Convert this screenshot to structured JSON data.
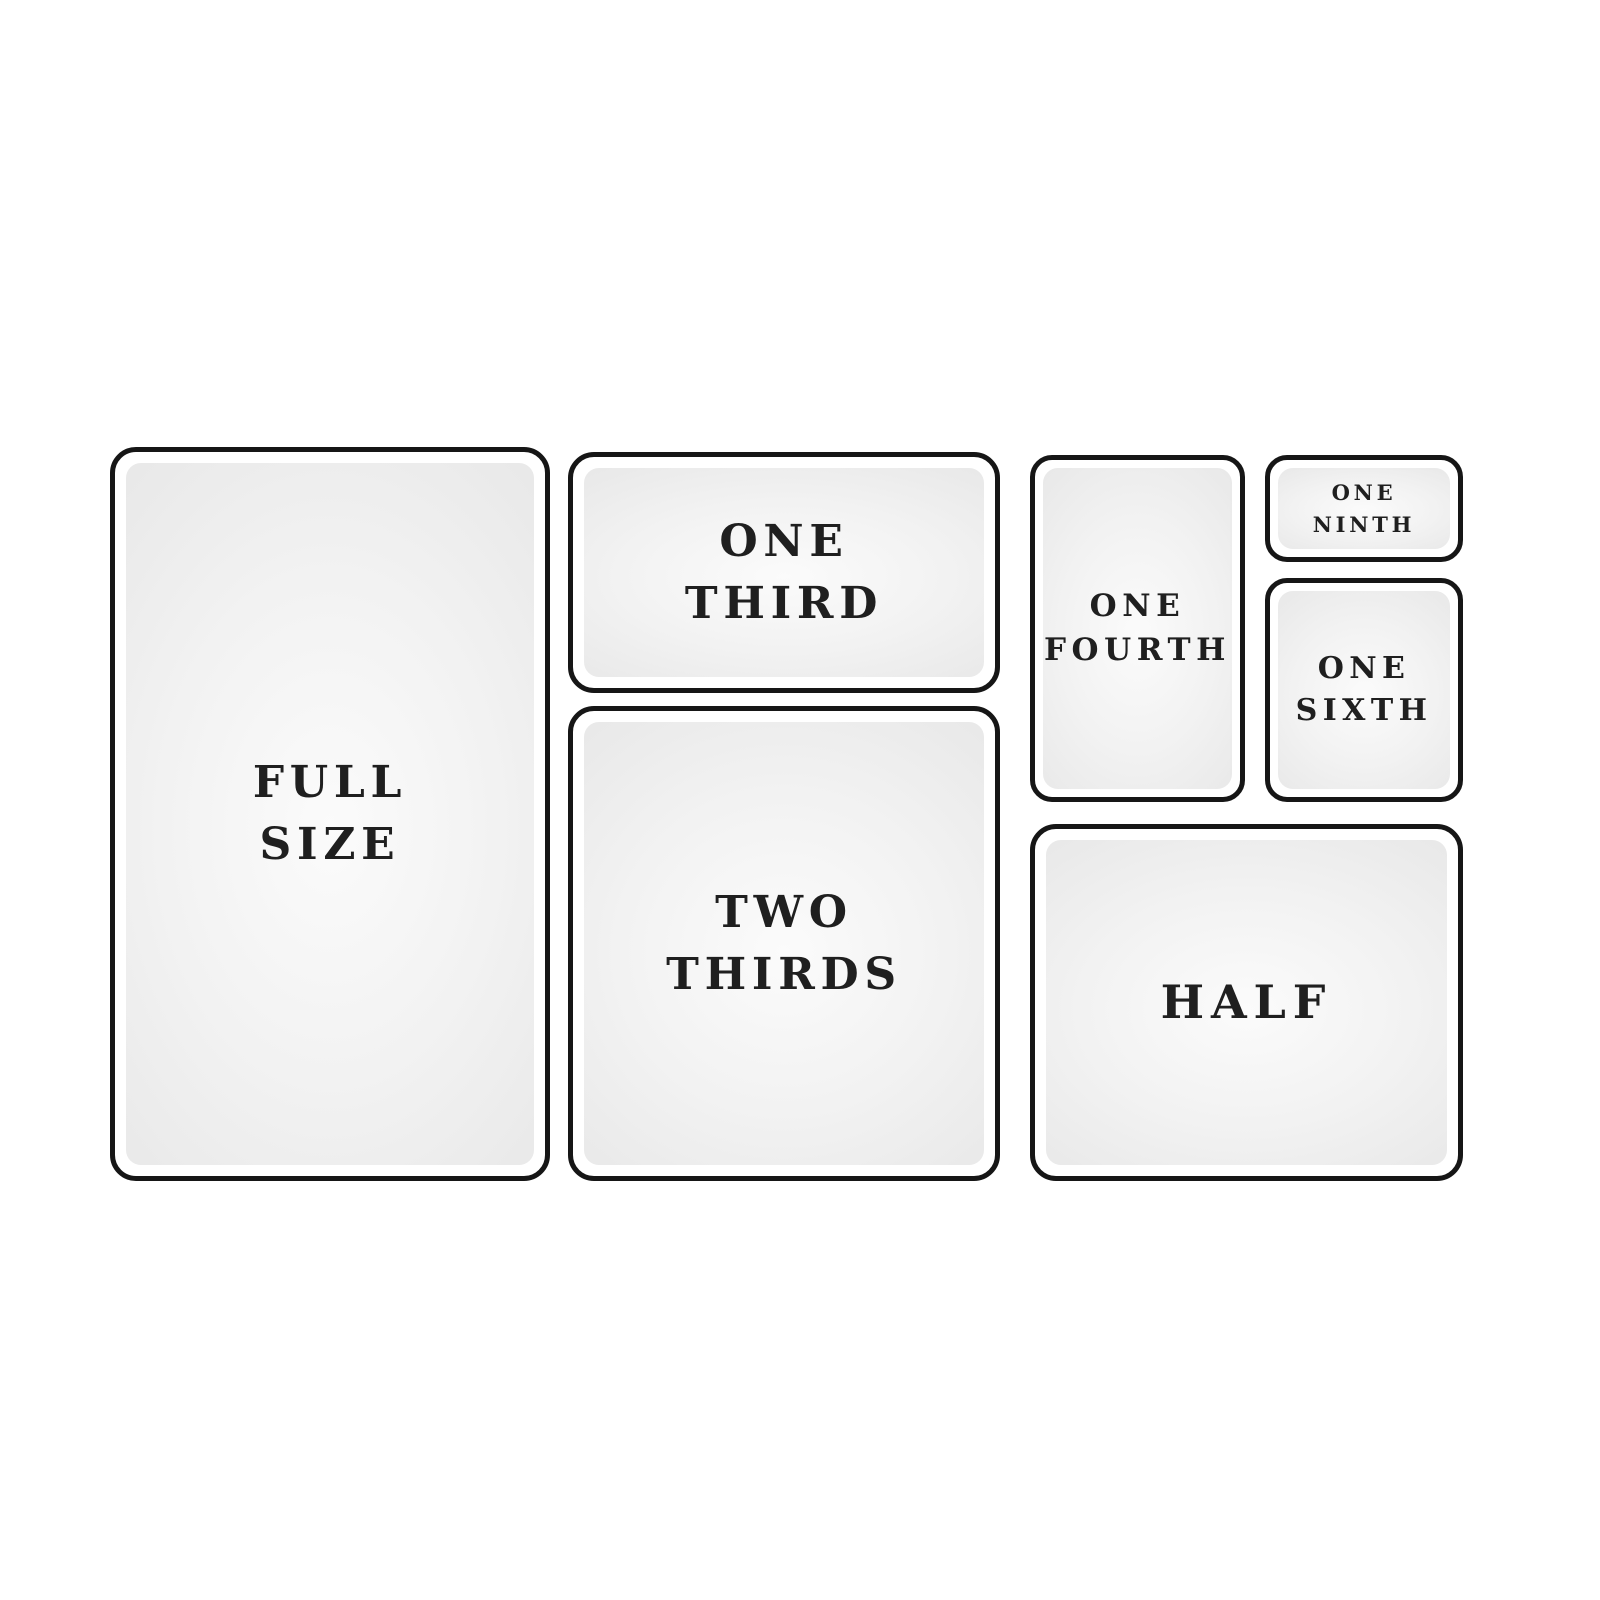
{
  "diagram": {
    "kind": "hotel-pan-size-chart",
    "panels": {
      "full_size": {
        "name": "Full Size",
        "lines": [
          "FULL",
          "SIZE"
        ]
      },
      "one_third": {
        "name": "One Third",
        "lines": [
          "ONE",
          "THIRD"
        ]
      },
      "two_thirds": {
        "name": "Two Thirds",
        "lines": [
          "TWO",
          "THIRDS"
        ]
      },
      "one_fourth": {
        "name": "One Fourth",
        "lines": [
          "ONE",
          "FOURTH"
        ]
      },
      "one_ninth": {
        "name": "One Ninth",
        "lines": [
          "ONE",
          "NINTH"
        ]
      },
      "one_sixth": {
        "name": "One Sixth",
        "lines": [
          "ONE",
          "SIXTH"
        ]
      },
      "half": {
        "name": "Half",
        "lines": [
          "HALF"
        ]
      }
    }
  },
  "colors": {
    "bg": "#ffffff",
    "border": "#161616",
    "text": "#1f1f1f",
    "fill_center": "#fbfbfb",
    "fill_mid": "#f2f2f2",
    "fill_edge": "#e9e9e9"
  }
}
